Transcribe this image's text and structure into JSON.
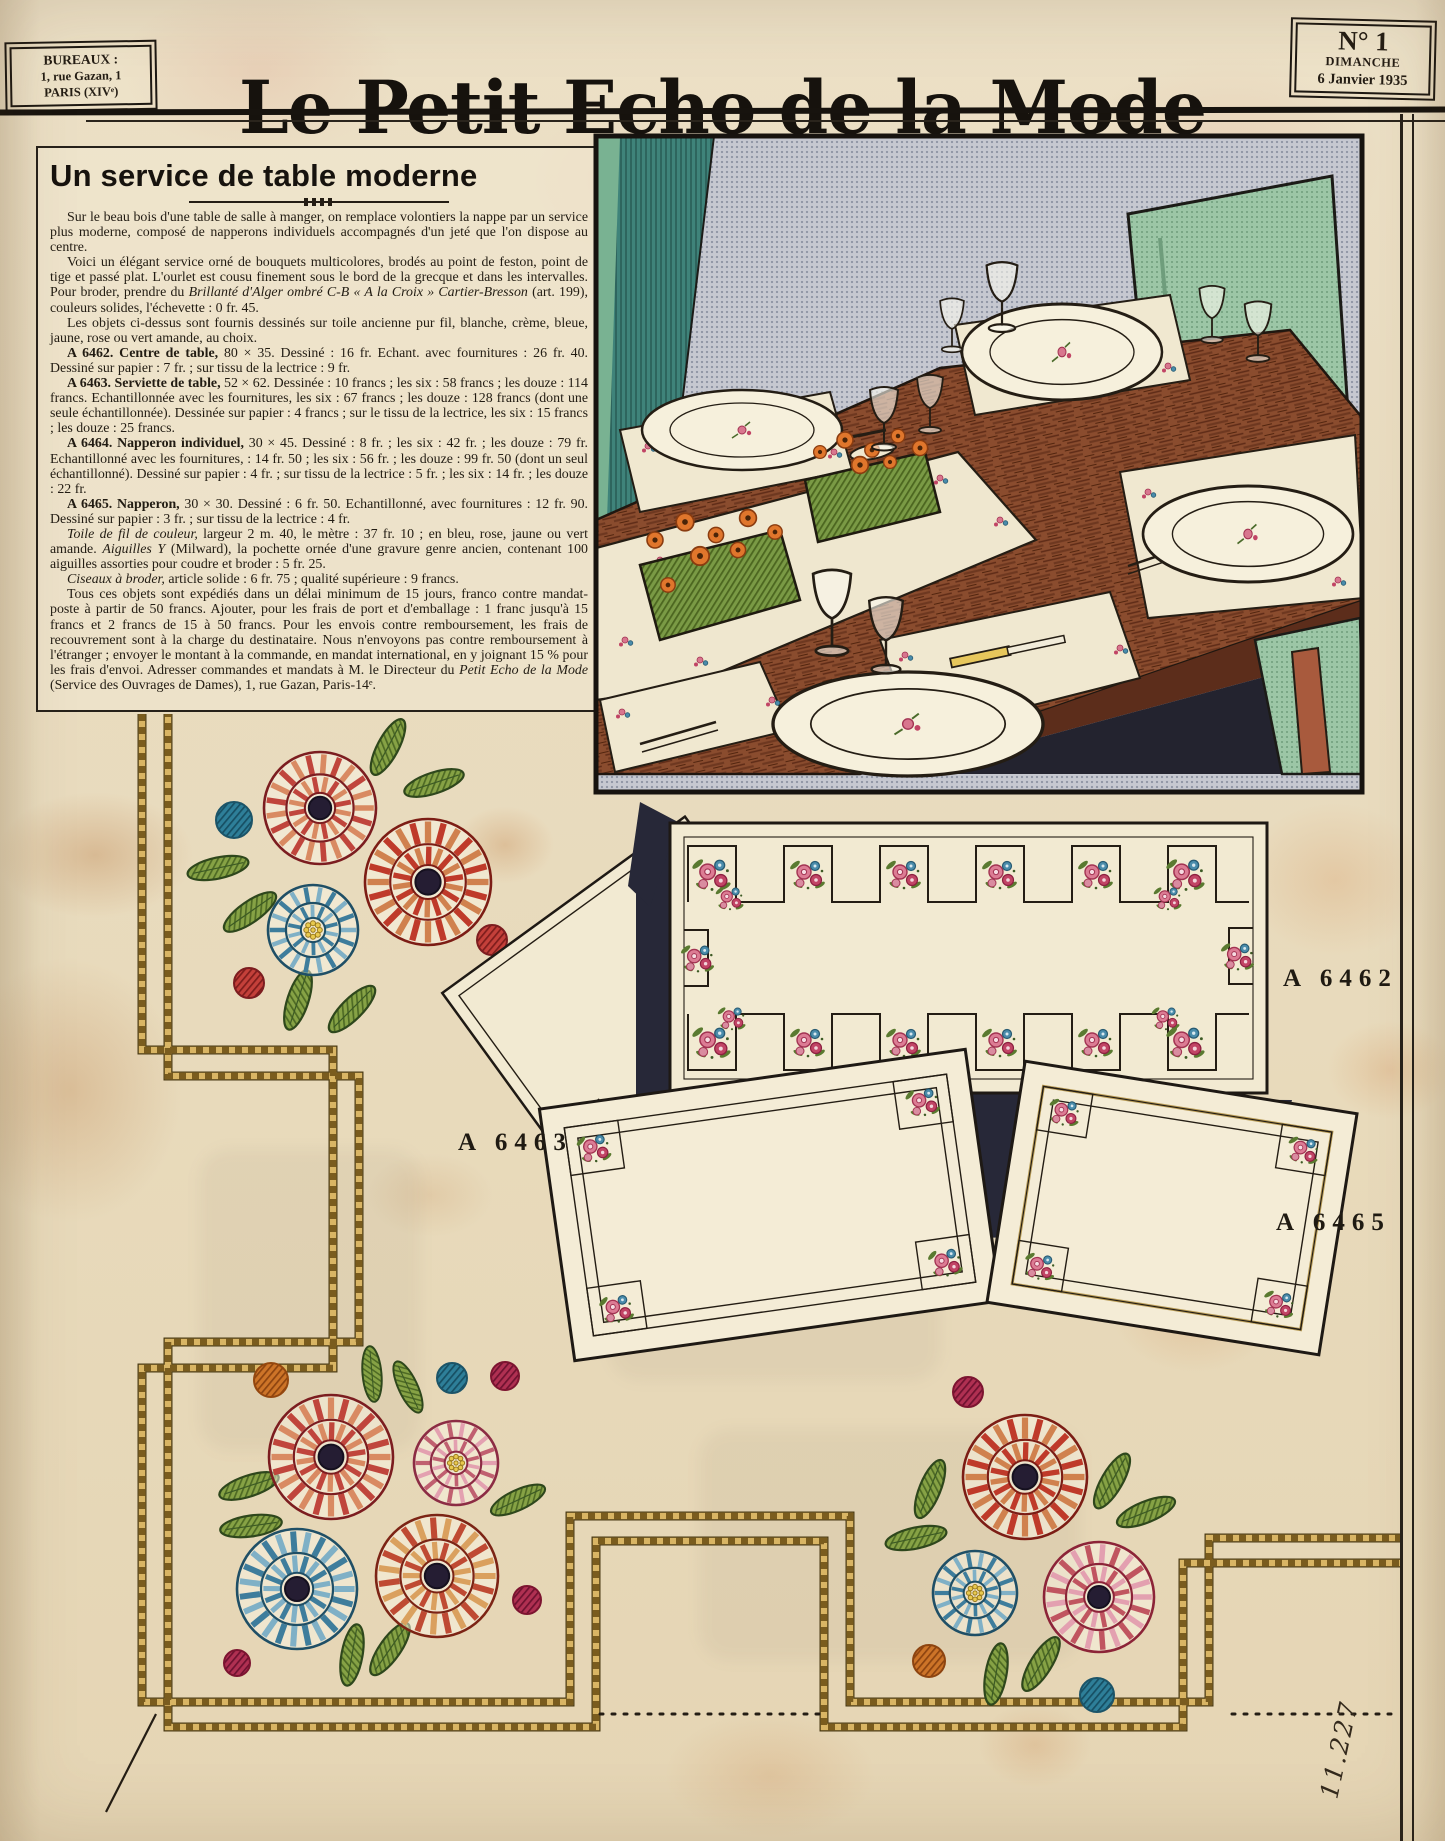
{
  "header": {
    "bureaux": {
      "line1": "BUREAUX :",
      "line2": "1, rue Gazan, 1",
      "line3": "PARIS (XIVᵉ)"
    },
    "title": "Le Petit Echo de la Mode",
    "issue": {
      "number": "N° 1",
      "day": "DIMANCHE",
      "date": "6 Janvier 1935"
    }
  },
  "article": {
    "title": "Un service de table moderne",
    "paragraphs": [
      {
        "segments": [
          {
            "style": "n",
            "text": "Sur le beau bois d'une table de salle à manger, on remplace volontiers la nappe par un service plus moderne, composé de napperons individuels accompagnés d'un jeté que l'on dispose au centre."
          }
        ]
      },
      {
        "segments": [
          {
            "style": "n",
            "text": "Voici un élégant service orné de bouquets multicolores, brodés au point de feston, point de tige et passé plat. L'ourlet est cousu finement sous le bord de la grecque et dans les intervalles. Pour broder, prendre du "
          },
          {
            "style": "i",
            "text": "Brillanté d'Alger ombré C-B « A la Croix » Cartier-Bresson"
          },
          {
            "style": "n",
            "text": " (art. 199), couleurs solides, l'échevette : 0 fr. 45."
          }
        ]
      },
      {
        "segments": [
          {
            "style": "n",
            "text": "Les objets ci-dessus sont fournis dessinés sur toile ancienne pur fil, blanche, crème, bleue, jaune, rose ou vert amande, au choix."
          }
        ]
      },
      {
        "segments": [
          {
            "style": "b",
            "text": "A 6462. Centre de table,"
          },
          {
            "style": "n",
            "text": " 80 × 35. Dessiné : 16 fr. Echant. avec fournitures : 26 fr. 40. Dessiné sur papier : 7 fr. ; sur tissu de la lectrice : 9 fr."
          }
        ]
      },
      {
        "segments": [
          {
            "style": "b",
            "text": "A 6463. Serviette de table,"
          },
          {
            "style": "n",
            "text": " 52 × 62. Dessinée : 10 francs ; les six : 58 francs ; les douze : 114 francs. Echantillonnée avec les fournitures, les six : 67 francs ; les douze : 128 francs (dont une seule échantillonnée). Dessinée sur papier : 4 francs ; sur le tissu de la lectrice, les six : 15 francs ; les douze : 25 francs."
          }
        ]
      },
      {
        "segments": [
          {
            "style": "b",
            "text": "A 6464. Napperon individuel,"
          },
          {
            "style": "n",
            "text": " 30 × 45. Dessiné : 8 fr. ; les six : 42 fr. ; les douze : 79 fr. Echantillonné avec les fournitures, : 14 fr. 50 ; les six : 56 fr. ; les douze : 99 fr. 50 (dont un seul échantillonné). Dessiné sur papier : 4 fr. ; sur tissu de la lectrice : 5 fr. ; les six : 14 fr. ; les douze : 22 fr."
          }
        ]
      },
      {
        "segments": [
          {
            "style": "b",
            "text": "A 6465. Napperon,"
          },
          {
            "style": "n",
            "text": " 30 × 30. Dessiné : 6 fr. 50. Echantillonné, avec fournitures : 12 fr. 90. Dessiné sur papier : 3 fr. ; sur tissu de la lectrice : 4 fr."
          }
        ]
      },
      {
        "segments": [
          {
            "style": "i",
            "text": "Toile de fil de couleur,"
          },
          {
            "style": "n",
            "text": " largeur 2 m. 40, le mètre : 37 fr. 10 ; en bleu, rose, jaune ou vert amande. "
          },
          {
            "style": "i",
            "text": "Aiguilles Y"
          },
          {
            "style": "n",
            "text": " (Milward), la pochette ornée d'une gravure genre ancien, contenant 100 aiguilles assorties pour coudre et broder : 5 fr. 25."
          }
        ]
      },
      {
        "segments": [
          {
            "style": "i",
            "text": "Ciseaux à broder,"
          },
          {
            "style": "n",
            "text": " article solide : 6 fr. 75 ; qualité supérieure : 9 francs."
          }
        ]
      },
      {
        "segments": [
          {
            "style": "n",
            "text": "Tous ces objets sont expédiés dans un délai minimum de 15 jours, franco contre mandat-poste à partir de 50 francs. Ajouter, pour les frais de port et d'emballage : 1 franc jusqu'à 15 francs et 2 francs de 15 à 50 francs. Pour les envois contre remboursement, les frais de recouvrement sont à la charge du destinataire. Nous n'envoyons pas contre remboursement à l'étranger ; envoyer le montant à la commande, en mandat international, en y joignant 15 % pour les frais d'envoi. Adresser commandes et mandats à M. le Directeur du "
          },
          {
            "style": "i",
            "text": "Petit Echo de la Mode"
          },
          {
            "style": "n",
            "text": " (Service des Ouvrages de Dames), 1, rue Gazan, Paris-14ᵉ."
          }
        ]
      }
    ]
  },
  "pattern_labels": {
    "a6462": "A 6462",
    "a6463": "A 6463",
    "a6465": "A 6465"
  },
  "handwritten_number": "11.227",
  "colors": {
    "paper": "#e9dcc0",
    "ink": "#241d14",
    "navy_shadow": "#272838",
    "embroidery_red": "#bf3a2a",
    "embroidery_pink": "#c06070",
    "embroidery_blue": "#3e7d9c",
    "embroidery_green": "#86a245",
    "rope_gold": "#d9b564",
    "photo_wood": "#8a4c2e",
    "photo_chair_green": "#97c3a4",
    "photo_teal": "#3f837a"
  }
}
